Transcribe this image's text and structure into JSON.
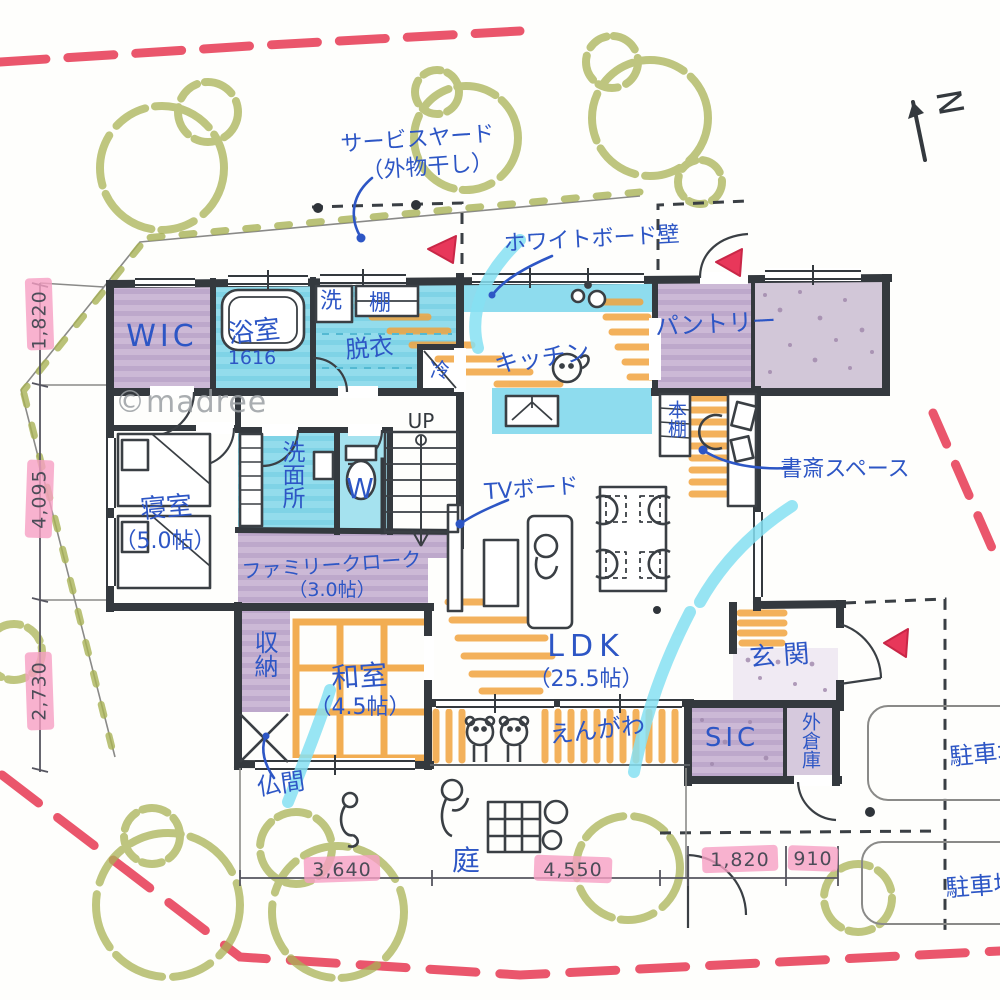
{
  "watermark": "©madree",
  "north_label": "N",
  "annotations": {
    "service_yard_line1": "サービスヤード",
    "service_yard_line2": "（外物干し）",
    "whiteboard_wall": "ホワイトボード壁",
    "tv_board": "TVボード",
    "study_space": "書斎スペース"
  },
  "rooms": {
    "wic": "WIC",
    "bath": "浴室",
    "bath_size": "1616",
    "washer": "洗",
    "shelf": "棚",
    "dressing": "脱衣",
    "fridge": "冷",
    "kitchen": "キッチン",
    "pantry": "パントリー",
    "bookshelf": "本棚",
    "bedroom": "寝室",
    "bedroom_size": "（5.0帖）",
    "washroom": "洗面所",
    "wc": "W",
    "stairs_up": "UP",
    "family_cloak": "ファミリークローク",
    "family_cloak_size": "（3.0帖）",
    "storage": "収納",
    "washitsu": "和室",
    "washitsu_size": "（4.5帖）",
    "butsuma": "仏間",
    "ldk": "LDK",
    "ldk_size": "（25.5帖）",
    "engawa": "えんがわ",
    "genkan": "玄関",
    "sic": "SIC",
    "outer_storage": "外倉庫",
    "garden": "庭",
    "parking_upper": "駐車場",
    "parking_lower": "駐車場"
  },
  "dimensions": {
    "left": [
      "1,820",
      "4,095",
      "2,730"
    ],
    "bottom": [
      "3,640",
      "4,550",
      "1,820",
      "910"
    ]
  },
  "colors": {
    "wall": "#34393e",
    "room_blue": "#8edcee",
    "room_purple": "#c9b6d3",
    "tatami_orange": "#f2a43f",
    "tree_olive": "#a9b356",
    "boundary_red": "#e8445c",
    "dim_pink": "#f79fc3",
    "label_blue": "#2d56c5",
    "marker_cyan": "#86e0f2"
  }
}
